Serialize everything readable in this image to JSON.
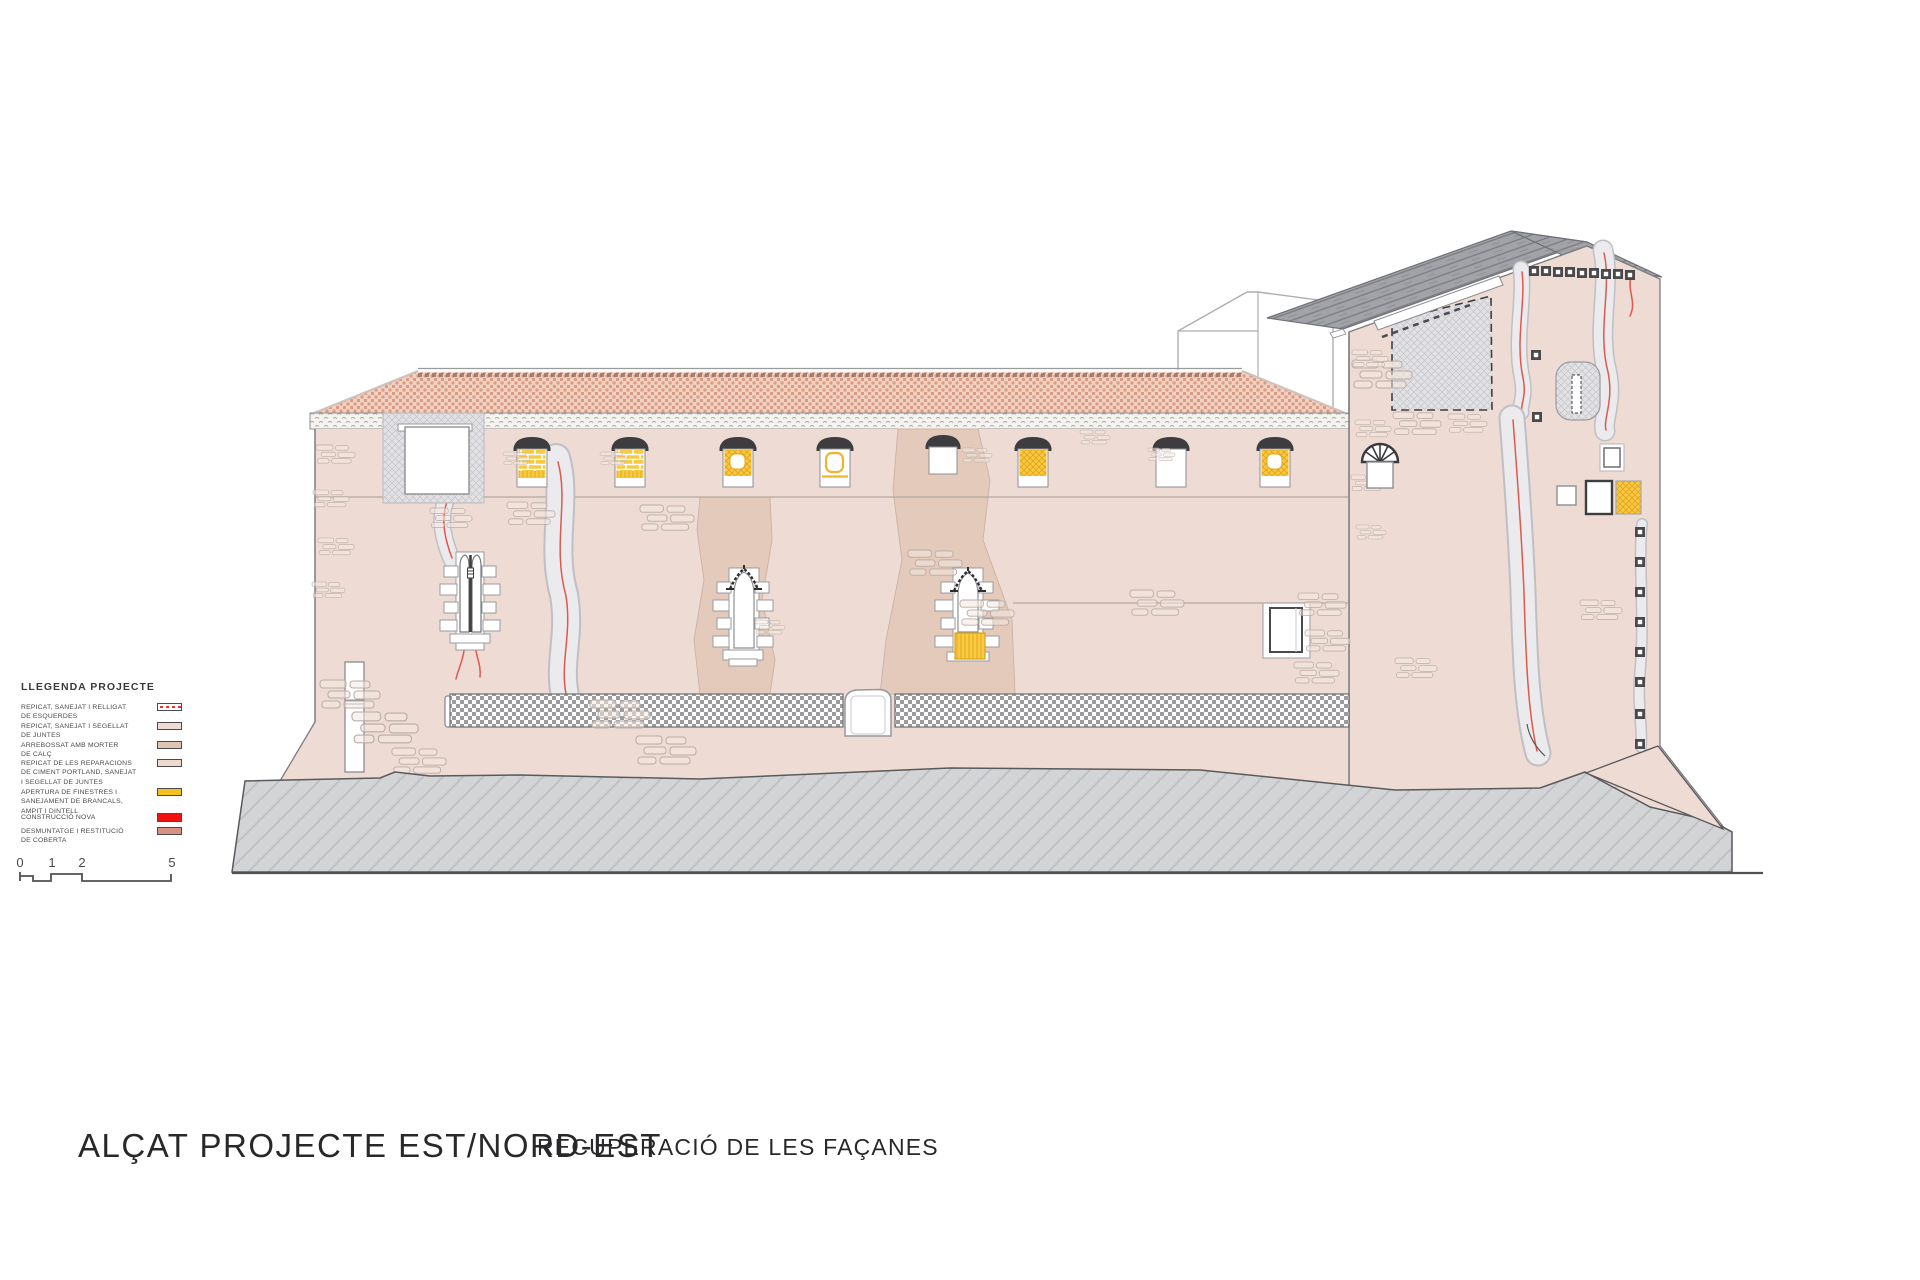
{
  "titles": {
    "main": "ALÇAT PROJECTE EST/NORD-EST",
    "subtitle": "RECUPERACIÓ DE LES FAÇANES"
  },
  "legend": {
    "title": "LLEGENDA PROJECTE",
    "items": [
      {
        "label": "REPICAT, SANEJAT I RELLIGAT\nDE ESQUERDES",
        "swatch": "#ffffff"
      },
      {
        "label": "REPICAT, SANEJAT I SEGELLAT\nDE JUNTES",
        "swatch": "#f0dcd4"
      },
      {
        "label": "ARREBOSSAT AMB MORTER\nDE CALÇ",
        "swatch": "#dfc5b2"
      },
      {
        "label": "REPICAT DE LES REPARACIONS\nDE CIMENT PORTLAND, SANEJAT\nI SEGELLAT DE JUNTES",
        "swatch": "#eedacd"
      },
      {
        "label": "APERTURA DE FINESTRES I\nSANEJAMENT DE BRANCALS,\nAMPIT I DINTELL",
        "swatch": "#f5c020"
      },
      {
        "label": "CONSTRUCCIÓ NOVA",
        "swatch": "#ee1511"
      },
      {
        "label": "DESMUNTATGE I RESTITUCIÓ\nDE COBERTA",
        "swatch": "#d69383"
      }
    ]
  },
  "scale_bar": {
    "labels": [
      "0",
      "1",
      "2",
      "5"
    ]
  },
  "colors": {
    "wall": "#eedbd3",
    "mortar_band": "#e3cabb",
    "roof_tile_dot": "#dc9a81",
    "roof_tile_bg": "#f0d2c4",
    "tower_roof": "#a1a3a8",
    "terrain": "#d3d4d6",
    "repair_yellow": "#f8ca41",
    "new_construction_red": "#ee1511",
    "roof_restitution_salmon": "#d69383",
    "crack_red": "#e2574c"
  }
}
